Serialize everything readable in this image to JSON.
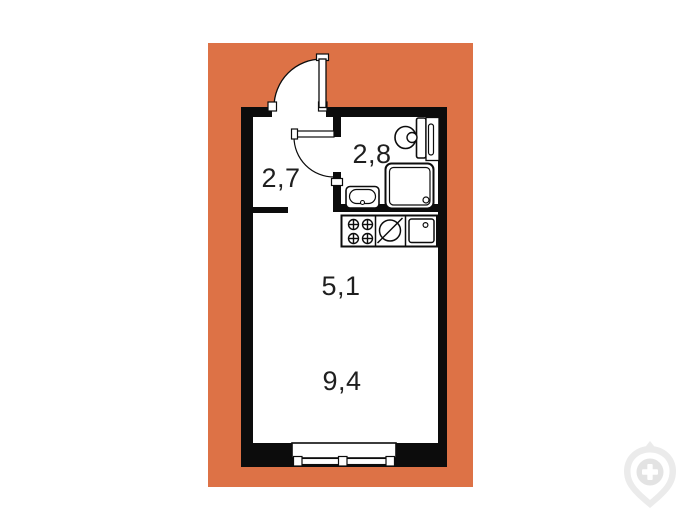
{
  "page": {
    "background_color": "#ffffff",
    "description": "studio apartment floor plan on orange card"
  },
  "plan": {
    "background_color": "#dd7246",
    "wall_color": "#0c0c0c",
    "floor_color": "#ffffff",
    "rooms": [
      {
        "name": "hallway",
        "area_label": "2,7"
      },
      {
        "name": "bathroom",
        "area_label": "2,8"
      },
      {
        "name": "kitchen-zone",
        "area_label": "5,1"
      },
      {
        "name": "living-zone",
        "area_label": "9,4"
      }
    ],
    "fixtures": [
      "entry-door-swing",
      "bathroom-door-swing",
      "toilet",
      "plumbing-shaft",
      "shower-cabin",
      "washbasin",
      "stove-burners",
      "kitchen-sink",
      "kitchen-counter",
      "window"
    ]
  },
  "watermark": {
    "icon": "developer-logo-icon",
    "color": "#ebebeb"
  }
}
